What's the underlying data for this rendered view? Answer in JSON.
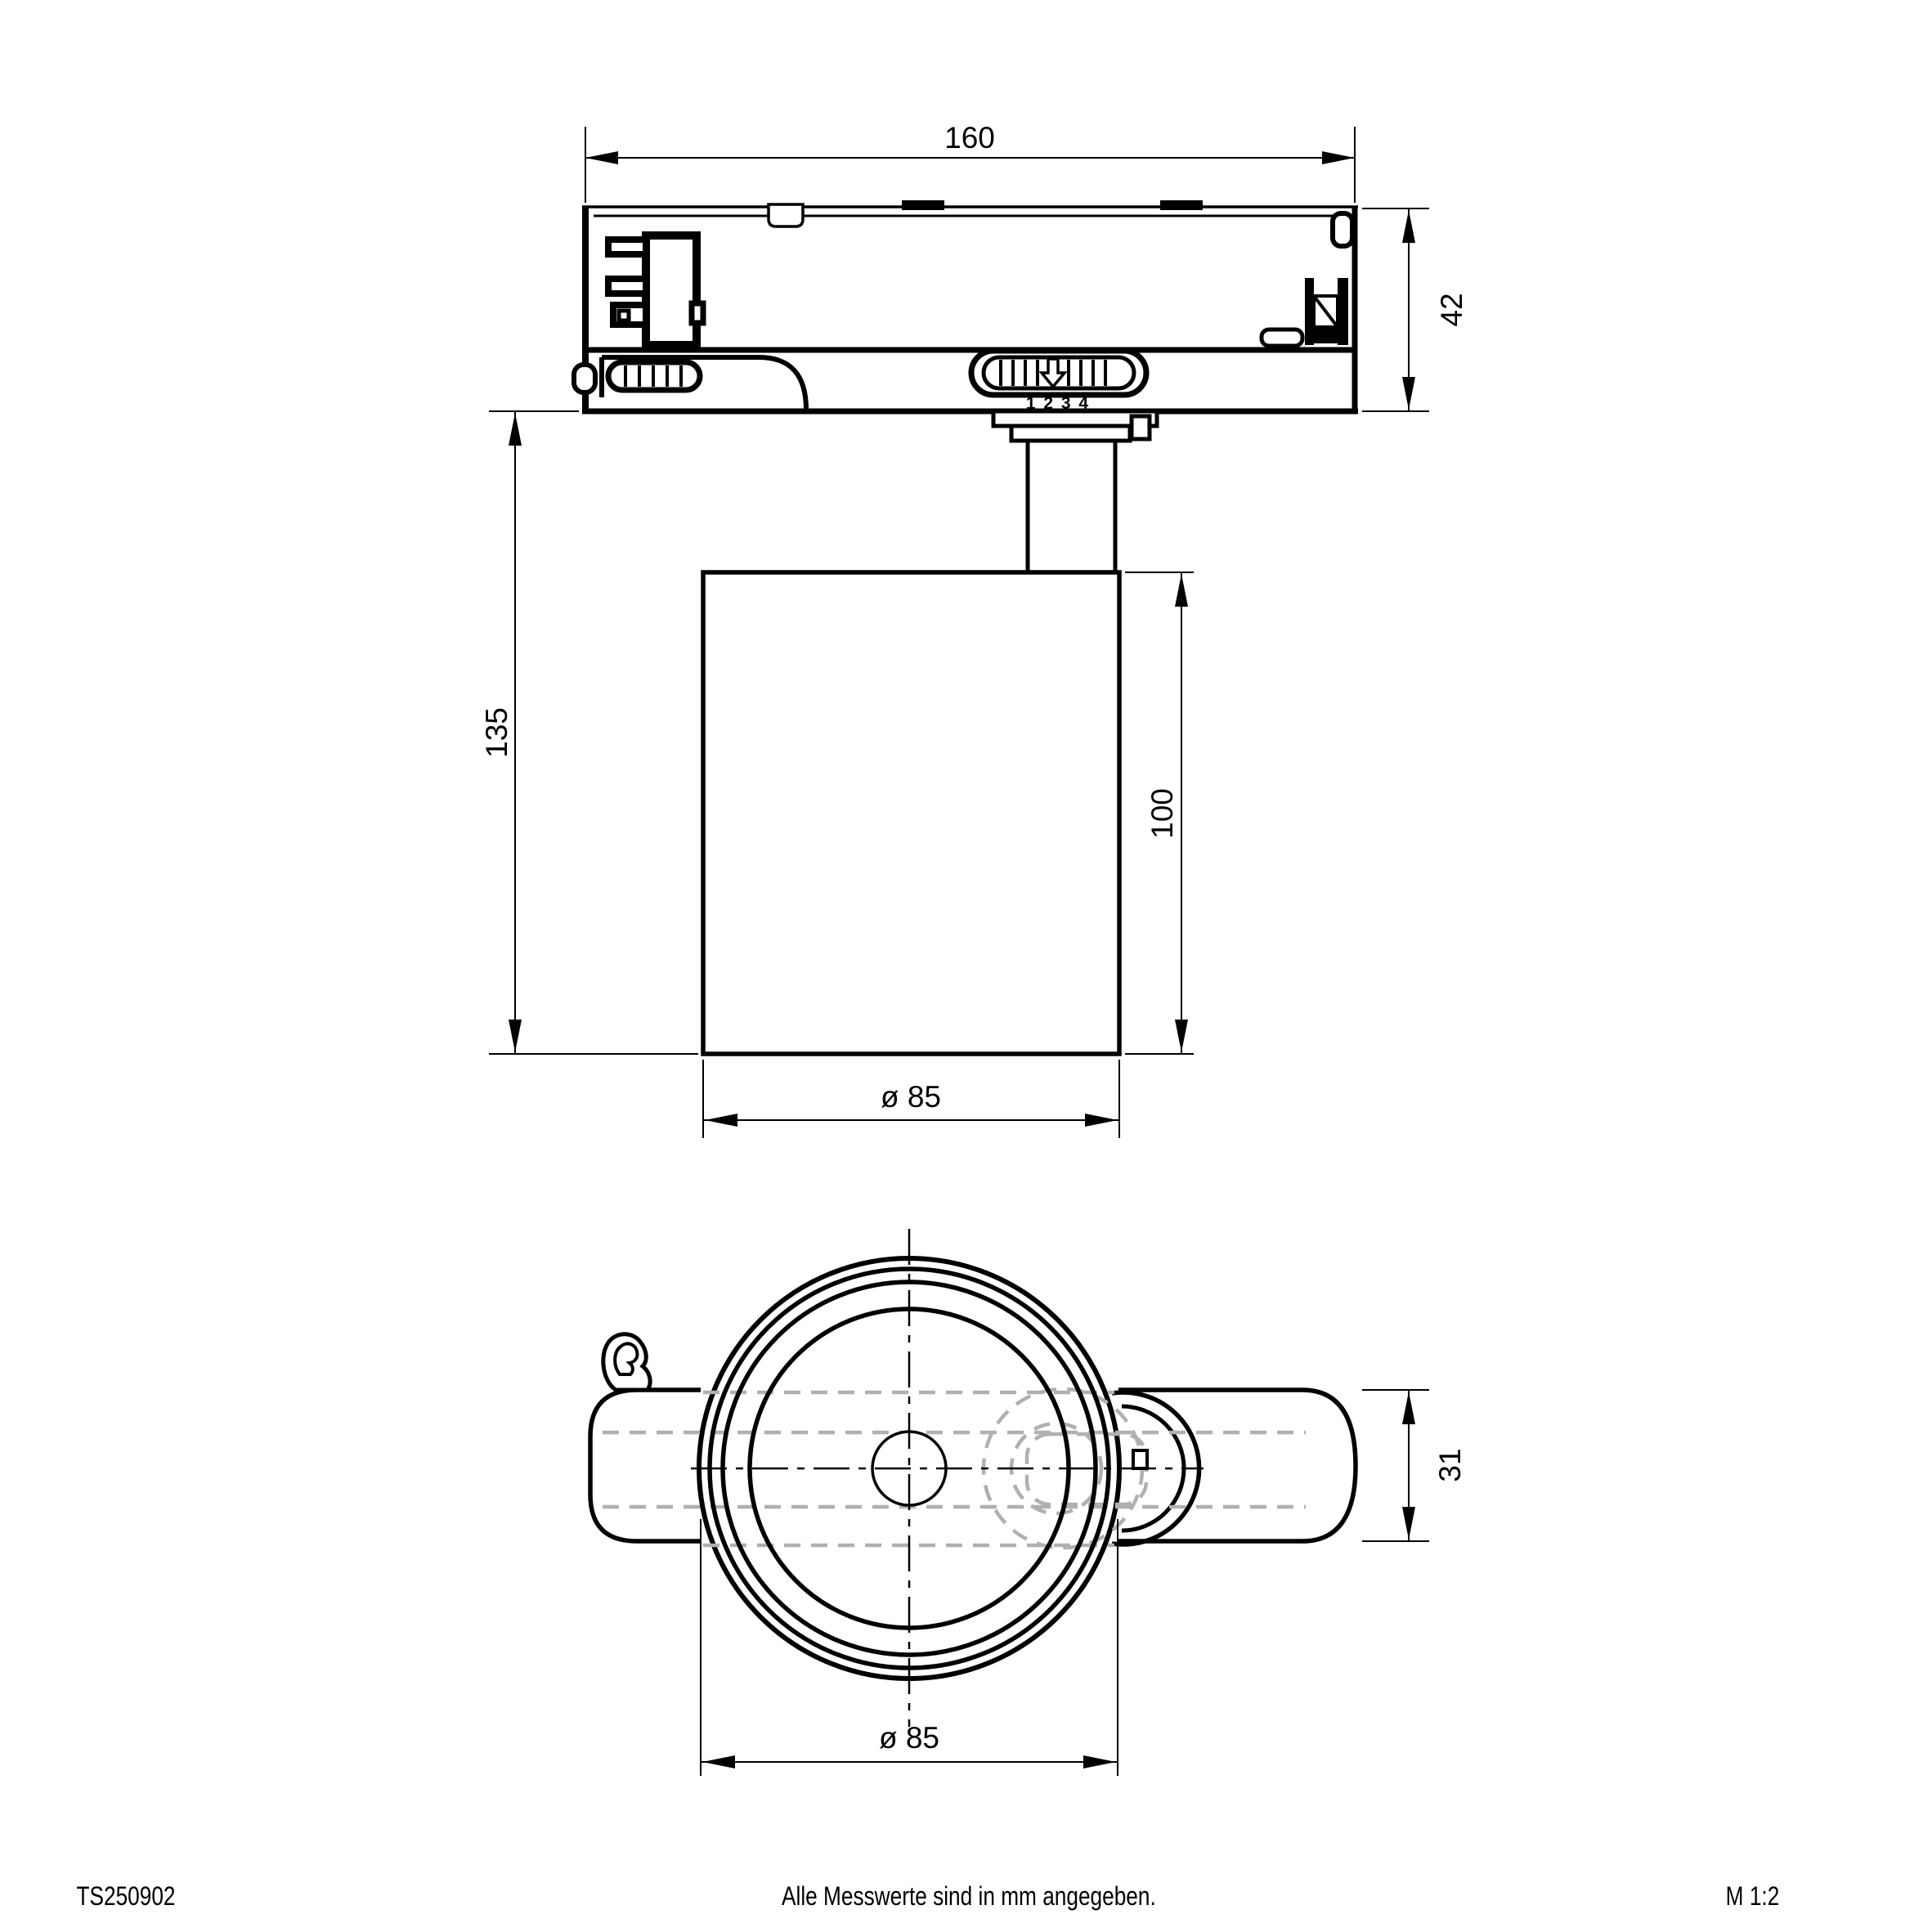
{
  "drawing": {
    "side_view": {
      "width_label": "160",
      "adapter_height_label": "42",
      "overall_height_label": "135",
      "body_height_label": "100",
      "diameter_label": "ø 85",
      "switch_scale": "1 2 3 4"
    },
    "bottom_view": {
      "diameter_label": "ø 85",
      "adapter_width_label": "31"
    },
    "footer": {
      "article_number": "TS250902",
      "note": "Alle Messwerte sind in mm angegeben.",
      "scale": "M 1:2"
    },
    "colors": {
      "line": "#000000",
      "hidden_line": "#b0b0b0",
      "background": "#ffffff"
    }
  }
}
